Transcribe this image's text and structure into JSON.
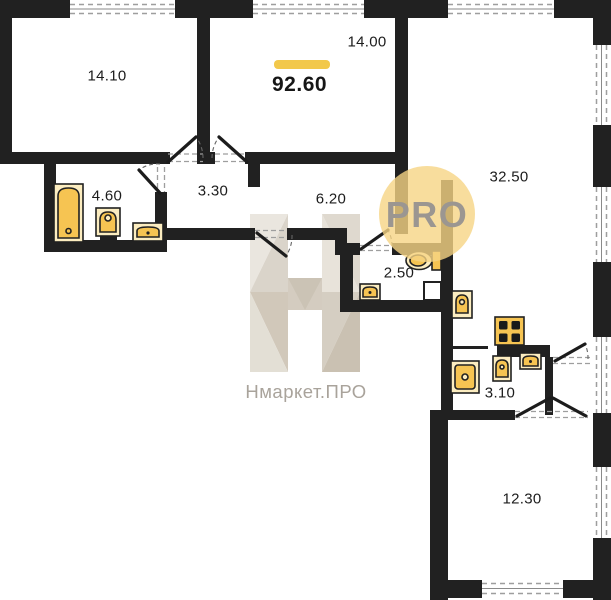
{
  "plan": {
    "total_area": "92.60",
    "rooms": [
      {
        "name": "bedroom-left",
        "area": "14.10"
      },
      {
        "name": "bedroom-middle",
        "area": "14.00"
      },
      {
        "name": "living-room",
        "area": "32.50"
      },
      {
        "name": "bathroom",
        "area": "4.60"
      },
      {
        "name": "hall-small",
        "area": "3.30"
      },
      {
        "name": "hall-large",
        "area": "6.20"
      },
      {
        "name": "wc",
        "area": "2.50"
      },
      {
        "name": "kitchen-niche",
        "area": "3.10"
      },
      {
        "name": "bedroom-bottom",
        "area": "12.30"
      }
    ],
    "watermark": {
      "badge_text": "PRO",
      "brand_text": "Нмаркет.ПРО"
    },
    "fixture_icons": [
      "bathtub-icon",
      "pedestal-sink-icon",
      "small-sink-icon",
      "wc-sink-icon",
      "toilet-icon",
      "hall-sink-icon",
      "washing-machine-icon",
      "stove-icon",
      "kitchen-sink-icon",
      "kitchen-basin-icon"
    ],
    "colors": {
      "wall": "#212121",
      "accent_bar": "#f2c84b",
      "badge_circle": "#f6d584",
      "badge_text": "#9b9691",
      "fixture_fill": "#f6c452",
      "fixture_bg": "#fcedc0",
      "watermark_text": "#a9a39b"
    }
  }
}
